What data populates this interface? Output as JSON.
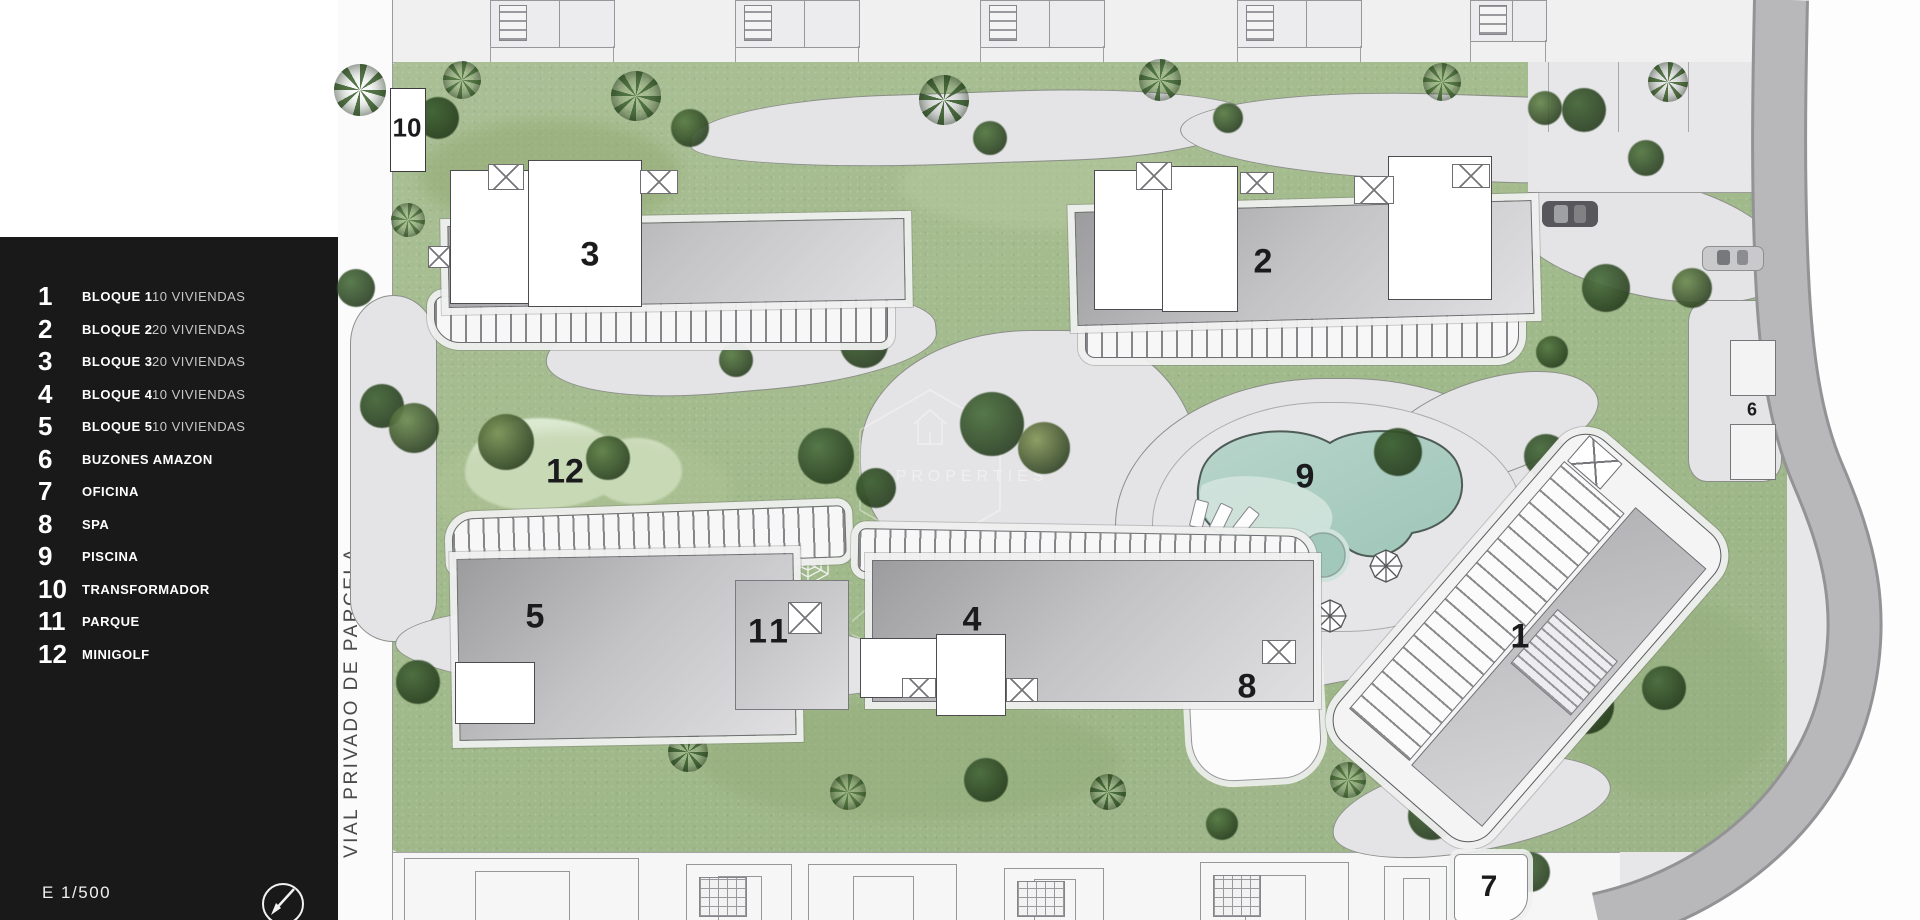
{
  "legend": {
    "items": [
      {
        "num": "1",
        "label": "BLOQUE 1",
        "detail": "10 VIVIENDAS"
      },
      {
        "num": "2",
        "label": "BLOQUE 2",
        "detail": "20 VIVIENDAS"
      },
      {
        "num": "3",
        "label": "BLOQUE 3",
        "detail": "20 VIVIENDAS"
      },
      {
        "num": "4",
        "label": "BLOQUE 4",
        "detail": "10 VIVIENDAS"
      },
      {
        "num": "5",
        "label": "BLOQUE 5",
        "detail": "10 VIVIENDAS"
      },
      {
        "num": "6",
        "label": "BUZONES AMAZON",
        "detail": ""
      },
      {
        "num": "7",
        "label": "OFICINA",
        "detail": ""
      },
      {
        "num": "8",
        "label": "SPA",
        "detail": ""
      },
      {
        "num": "9",
        "label": "PISCINA",
        "detail": ""
      },
      {
        "num": "10",
        "label": "TRANSFORMADOR",
        "detail": ""
      },
      {
        "num": "11",
        "label": "PARQUE",
        "detail": ""
      },
      {
        "num": "12",
        "label": "MINIGOLF",
        "detail": ""
      }
    ],
    "scale_label": "E 1/500"
  },
  "street": {
    "vertical_label": "VIAL PRIVADO DE PARCELA."
  },
  "plan": {
    "labels": [
      {
        "text": "10",
        "refers_to": "TRANSFORMADOR"
      },
      {
        "text": "3",
        "refers_to": "BLOQUE 3"
      },
      {
        "text": "2",
        "refers_to": "BLOQUE 2"
      },
      {
        "text": "12",
        "refers_to": "MINIGOLF"
      },
      {
        "text": "9",
        "refers_to": "PISCINA"
      },
      {
        "text": "5",
        "refers_to": "BLOQUE 5"
      },
      {
        "text": "11",
        "refers_to": "PARQUE"
      },
      {
        "text": "4",
        "refers_to": "BLOQUE 4"
      },
      {
        "text": "1",
        "refers_to": "BLOQUE 1"
      },
      {
        "text": "8",
        "refers_to": "SPA"
      },
      {
        "text": "6",
        "refers_to": "BUZONES AMAZON"
      },
      {
        "text": "7",
        "refers_to": "OFICINA"
      }
    ]
  },
  "watermark": {
    "text": "PROPERTIES"
  },
  "colors": {
    "legend_bg": "#191919",
    "grass": "#a3bc8e",
    "pool_water": "#a6cabe",
    "pool_shallow": "#d3e5de",
    "path": "#e4e4e6",
    "road": "#b7b7ba",
    "minigolf": "#dcead2"
  }
}
